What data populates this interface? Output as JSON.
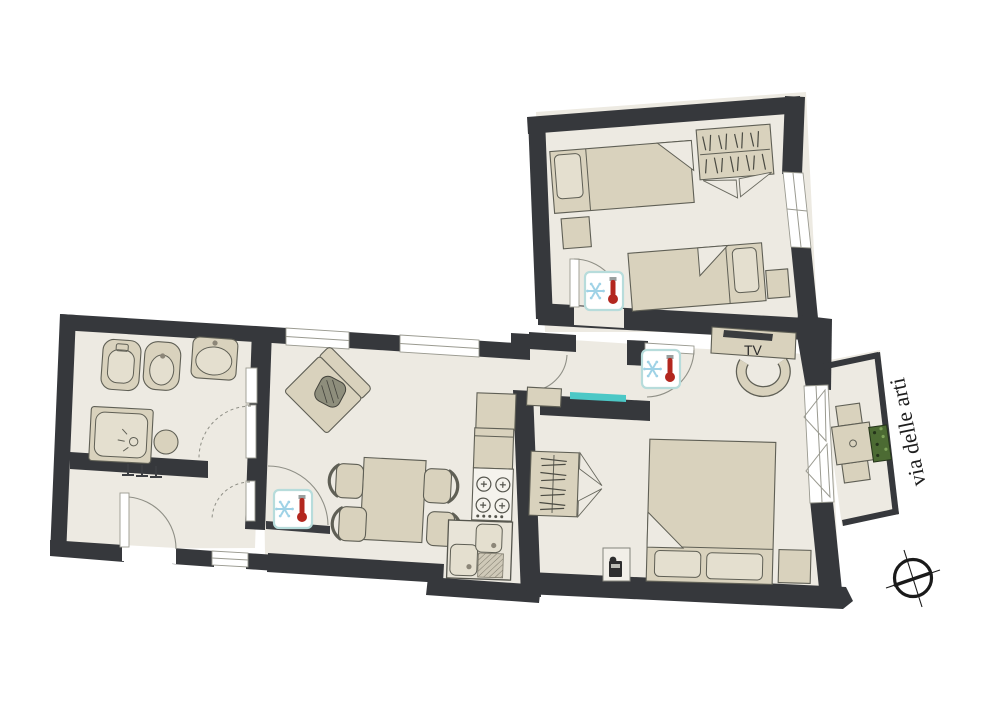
{
  "floorplan": {
    "street_label": "via delle arti",
    "tv_label": "TV",
    "colors": {
      "wall": "#36383c",
      "floor": "#edeae2",
      "furniture": "#d9d2bd",
      "furniture_stroke": "#5f5f55",
      "accent_teal": "#4cc8c6",
      "climate_border": "#b7dcdb",
      "snowflake_blue": "#9fd2e6",
      "thermometer_red": "#b3271f",
      "plant_green": "#4c6b33",
      "background": "#ffffff"
    },
    "icons": [
      "climate-control-icon",
      "snowflake-icon",
      "thermometer-icon",
      "compass-icon",
      "plant-box-icon",
      "safe-icon",
      "coat-hooks-icon",
      "hanger-rail-icon"
    ],
    "climate_icon_count": 3
  }
}
